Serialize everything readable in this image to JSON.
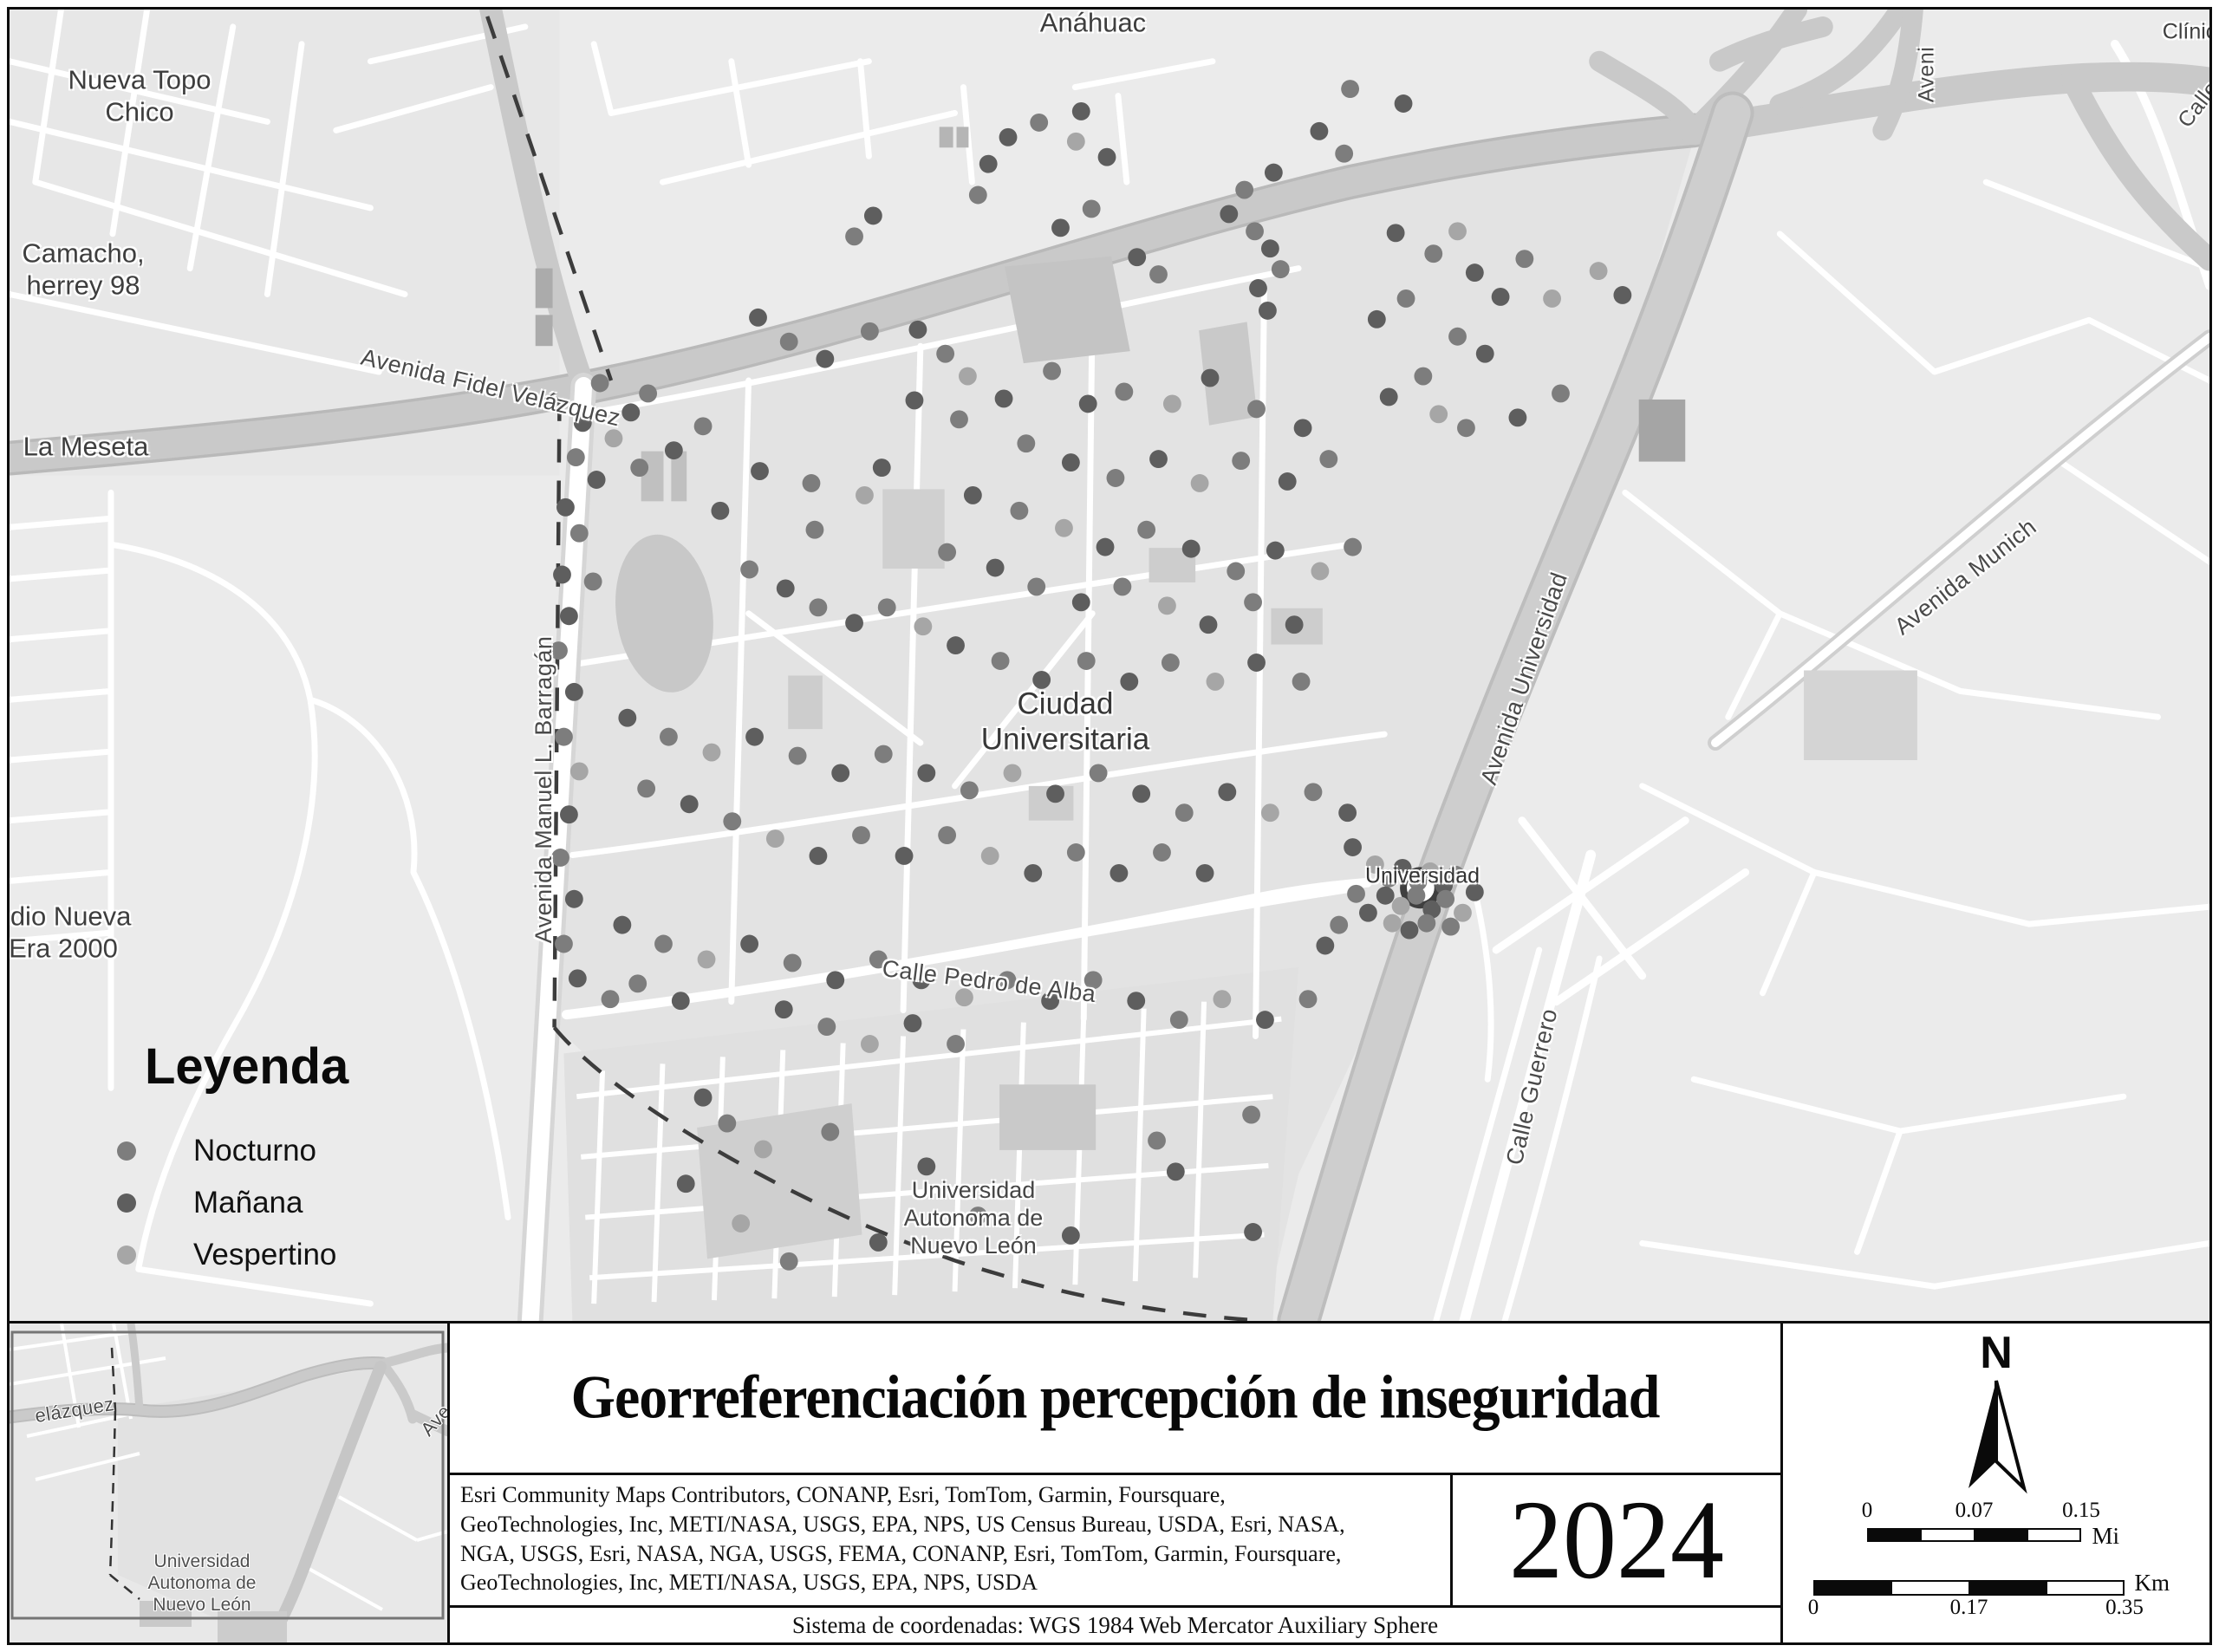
{
  "map": {
    "labels": {
      "anahuac": "Anáhuac",
      "nueva_topo_chico": "Nueva Topo\nChico",
      "camacho": "Camacho,\nherrey 98",
      "la_meseta": "La Meseta",
      "nueva_era": "edio Nueva\nEra 2000",
      "fidel_velazquez": "Avenida Fidel Velázquez",
      "barragan": "Avenida Manuel L. Barragán",
      "ciudad_universitaria": "Ciudad\nUniversitaria",
      "avenida_universidad": "Avenida Universidad",
      "avenida_munich": "Avenida Munich",
      "calle_guerrero": "Calle Guerrero",
      "universidad_station": "Universidad",
      "pedro_de_alba": "Calle Pedro de Alba",
      "uanl": "Universidad\nAutonoma de\nNuevo León",
      "clinica": "Clínica",
      "aveni": "Aveni",
      "calle": "Calle"
    },
    "legend": {
      "title": "Leyenda",
      "items": [
        {
          "key": "n",
          "label": "Nocturno",
          "color": "#7d7d7d"
        },
        {
          "key": "m",
          "label": "Mañana",
          "color": "#5e5e5e"
        },
        {
          "key": "v",
          "label": "Vespertino",
          "color": "#a6a6a6"
        }
      ]
    },
    "dot_colors": {
      "n": "#7d7d7d",
      "m": "#5e5e5e",
      "v": "#a6a6a6"
    },
    "dots": [
      [
        1162,
        148,
        "m"
      ],
      [
        1198,
        131,
        "n"
      ],
      [
        1139,
        179,
        "m"
      ],
      [
        1241,
        153,
        "v"
      ],
      [
        1277,
        171,
        "m"
      ],
      [
        1524,
        141,
        "m"
      ],
      [
        1553,
        167,
        "n"
      ],
      [
        1471,
        189,
        "m"
      ],
      [
        1437,
        209,
        "n"
      ],
      [
        1419,
        237,
        "m"
      ],
      [
        1449,
        257,
        "n"
      ],
      [
        1467,
        277,
        "m"
      ],
      [
        1127,
        215,
        "n"
      ],
      [
        1005,
        239,
        "m"
      ],
      [
        983,
        263,
        "n"
      ],
      [
        1223,
        253,
        "m"
      ],
      [
        1259,
        231,
        "n"
      ],
      [
        1312,
        287,
        "m"
      ],
      [
        1337,
        307,
        "n"
      ],
      [
        1453,
        323,
        "m"
      ],
      [
        1479,
        301,
        "n"
      ],
      [
        1464,
        349,
        "m"
      ],
      [
        1560,
        92,
        "n"
      ],
      [
        1622,
        109,
        "m"
      ],
      [
        1247,
        118,
        "m"
      ],
      [
        1613,
        259,
        "m"
      ],
      [
        1657,
        283,
        "n"
      ],
      [
        1685,
        257,
        "v"
      ],
      [
        1705,
        305,
        "m"
      ],
      [
        1763,
        289,
        "n"
      ],
      [
        1735,
        333,
        "m"
      ],
      [
        1795,
        335,
        "v"
      ],
      [
        1625,
        335,
        "n"
      ],
      [
        1591,
        359,
        "m"
      ],
      [
        1685,
        379,
        "n"
      ],
      [
        1717,
        399,
        "m"
      ],
      [
        1645,
        425,
        "n"
      ],
      [
        1605,
        449,
        "m"
      ],
      [
        1663,
        469,
        "v"
      ],
      [
        1695,
        485,
        "n"
      ],
      [
        1755,
        473,
        "m"
      ],
      [
        1805,
        445,
        "n"
      ],
      [
        1849,
        303,
        "v"
      ],
      [
        1877,
        331,
        "m"
      ],
      [
        871,
        357,
        "m"
      ],
      [
        907,
        385,
        "n"
      ],
      [
        949,
        405,
        "m"
      ],
      [
        1001,
        373,
        "n"
      ],
      [
        1057,
        371,
        "m"
      ],
      [
        1089,
        399,
        "n"
      ],
      [
        1115,
        425,
        "v"
      ],
      [
        1053,
        453,
        "m"
      ],
      [
        1105,
        475,
        "n"
      ],
      [
        1157,
        451,
        "m"
      ],
      [
        1213,
        419,
        "n"
      ],
      [
        1255,
        457,
        "m"
      ],
      [
        1297,
        443,
        "n"
      ],
      [
        1353,
        457,
        "v"
      ],
      [
        1397,
        427,
        "m"
      ],
      [
        1451,
        463,
        "n"
      ],
      [
        1505,
        485,
        "m"
      ],
      [
        1183,
        503,
        "n"
      ],
      [
        1235,
        525,
        "m"
      ],
      [
        1287,
        543,
        "n"
      ],
      [
        1337,
        521,
        "m"
      ],
      [
        1385,
        549,
        "v"
      ],
      [
        1433,
        523,
        "n"
      ],
      [
        1487,
        547,
        "m"
      ],
      [
        1535,
        521,
        "n"
      ],
      [
        687,
        433,
        "n"
      ],
      [
        667,
        479,
        "m"
      ],
      [
        703,
        497,
        "v"
      ],
      [
        723,
        467,
        "m"
      ],
      [
        743,
        445,
        "n"
      ],
      [
        659,
        519,
        "n"
      ],
      [
        683,
        545,
        "m"
      ],
      [
        733,
        531,
        "n"
      ],
      [
        773,
        511,
        "m"
      ],
      [
        807,
        483,
        "n"
      ],
      [
        647,
        577,
        "m"
      ],
      [
        663,
        607,
        "n"
      ],
      [
        643,
        655,
        "m"
      ],
      [
        679,
        663,
        "n"
      ],
      [
        651,
        703,
        "m"
      ],
      [
        639,
        743,
        "n"
      ],
      [
        657,
        791,
        "m"
      ],
      [
        645,
        843,
        "n"
      ],
      [
        663,
        883,
        "v"
      ],
      [
        651,
        933,
        "m"
      ],
      [
        641,
        983,
        "n"
      ],
      [
        657,
        1031,
        "m"
      ],
      [
        645,
        1083,
        "n"
      ],
      [
        661,
        1123,
        "m"
      ],
      [
        699,
        1147,
        "n"
      ],
      [
        827,
        581,
        "m"
      ],
      [
        937,
        603,
        "n"
      ],
      [
        995,
        563,
        "v"
      ],
      [
        1015,
        531,
        "m"
      ],
      [
        933,
        549,
        "n"
      ],
      [
        873,
        535,
        "m"
      ],
      [
        1121,
        563,
        "m"
      ],
      [
        1175,
        581,
        "n"
      ],
      [
        1227,
        601,
        "v"
      ],
      [
        1275,
        623,
        "m"
      ],
      [
        1323,
        603,
        "n"
      ],
      [
        1375,
        625,
        "m"
      ],
      [
        1427,
        651,
        "n"
      ],
      [
        1473,
        627,
        "m"
      ],
      [
        1525,
        651,
        "v"
      ],
      [
        1563,
        623,
        "n"
      ],
      [
        1091,
        629,
        "n"
      ],
      [
        1147,
        647,
        "m"
      ],
      [
        1195,
        669,
        "n"
      ],
      [
        1247,
        687,
        "m"
      ],
      [
        1295,
        669,
        "n"
      ],
      [
        1347,
        691,
        "v"
      ],
      [
        1395,
        713,
        "m"
      ],
      [
        1447,
        687,
        "n"
      ],
      [
        1495,
        713,
        "m"
      ],
      [
        861,
        649,
        "n"
      ],
      [
        903,
        671,
        "m"
      ],
      [
        941,
        693,
        "n"
      ],
      [
        983,
        711,
        "m"
      ],
      [
        1021,
        693,
        "n"
      ],
      [
        1063,
        715,
        "v"
      ],
      [
        1101,
        737,
        "m"
      ],
      [
        1153,
        755,
        "n"
      ],
      [
        1201,
        777,
        "m"
      ],
      [
        1253,
        755,
        "n"
      ],
      [
        1303,
        779,
        "m"
      ],
      [
        1351,
        757,
        "n"
      ],
      [
        1403,
        779,
        "v"
      ],
      [
        1451,
        757,
        "m"
      ],
      [
        1503,
        779,
        "n"
      ],
      [
        719,
        821,
        "m"
      ],
      [
        767,
        843,
        "n"
      ],
      [
        817,
        861,
        "v"
      ],
      [
        867,
        843,
        "m"
      ],
      [
        917,
        865,
        "n"
      ],
      [
        967,
        885,
        "m"
      ],
      [
        1017,
        863,
        "n"
      ],
      [
        1067,
        885,
        "m"
      ],
      [
        1117,
        905,
        "n"
      ],
      [
        1167,
        885,
        "v"
      ],
      [
        1217,
        909,
        "m"
      ],
      [
        1267,
        885,
        "n"
      ],
      [
        1317,
        909,
        "m"
      ],
      [
        1367,
        931,
        "n"
      ],
      [
        1417,
        907,
        "m"
      ],
      [
        1467,
        931,
        "v"
      ],
      [
        1517,
        907,
        "n"
      ],
      [
        1557,
        931,
        "m"
      ],
      [
        741,
        903,
        "n"
      ],
      [
        791,
        921,
        "m"
      ],
      [
        841,
        941,
        "n"
      ],
      [
        891,
        961,
        "v"
      ],
      [
        941,
        981,
        "m"
      ],
      [
        991,
        957,
        "n"
      ],
      [
        1041,
        981,
        "m"
      ],
      [
        1091,
        957,
        "n"
      ],
      [
        1141,
        981,
        "v"
      ],
      [
        1191,
        1001,
        "m"
      ],
      [
        1241,
        977,
        "n"
      ],
      [
        1291,
        1001,
        "m"
      ],
      [
        1341,
        977,
        "n"
      ],
      [
        1391,
        1001,
        "m"
      ],
      [
        1589,
        991,
        "v"
      ],
      [
        1605,
        1007,
        "n"
      ],
      [
        1621,
        995,
        "m"
      ],
      [
        1639,
        1011,
        "n"
      ],
      [
        1653,
        999,
        "v"
      ],
      [
        1669,
        1015,
        "m"
      ],
      [
        1683,
        1003,
        "n"
      ],
      [
        1601,
        1027,
        "m"
      ],
      [
        1619,
        1039,
        "v"
      ],
      [
        1637,
        1027,
        "n"
      ],
      [
        1655,
        1043,
        "m"
      ],
      [
        1671,
        1031,
        "n"
      ],
      [
        1609,
        1059,
        "v"
      ],
      [
        1629,
        1067,
        "m"
      ],
      [
        1649,
        1059,
        "n"
      ],
      [
        1581,
        1047,
        "m"
      ],
      [
        1567,
        1025,
        "n"
      ],
      [
        1691,
        1047,
        "v"
      ],
      [
        1705,
        1023,
        "m"
      ],
      [
        1677,
        1063,
        "n"
      ],
      [
        1563,
        971,
        "m"
      ],
      [
        1547,
        1061,
        "n"
      ],
      [
        1531,
        1085,
        "m"
      ],
      [
        713,
        1061,
        "m"
      ],
      [
        761,
        1083,
        "n"
      ],
      [
        811,
        1101,
        "v"
      ],
      [
        861,
        1083,
        "m"
      ],
      [
        911,
        1105,
        "n"
      ],
      [
        961,
        1125,
        "m"
      ],
      [
        1011,
        1101,
        "n"
      ],
      [
        1061,
        1125,
        "m"
      ],
      [
        1111,
        1145,
        "v"
      ],
      [
        1161,
        1125,
        "n"
      ],
      [
        1211,
        1149,
        "m"
      ],
      [
        1261,
        1125,
        "n"
      ],
      [
        1311,
        1149,
        "m"
      ],
      [
        1361,
        1171,
        "n"
      ],
      [
        1411,
        1147,
        "v"
      ],
      [
        1461,
        1171,
        "m"
      ],
      [
        1511,
        1147,
        "n"
      ],
      [
        901,
        1159,
        "m"
      ],
      [
        951,
        1179,
        "n"
      ],
      [
        1001,
        1199,
        "v"
      ],
      [
        1051,
        1175,
        "m"
      ],
      [
        1101,
        1199,
        "n"
      ],
      [
        731,
        1129,
        "n"
      ],
      [
        781,
        1149,
        "m"
      ],
      [
        807,
        1261,
        "m"
      ],
      [
        835,
        1291,
        "n"
      ],
      [
        877,
        1321,
        "v"
      ],
      [
        787,
        1361,
        "m"
      ],
      [
        955,
        1301,
        "n"
      ],
      [
        1067,
        1341,
        "m"
      ],
      [
        1335,
        1311,
        "n"
      ],
      [
        1357,
        1347,
        "m"
      ],
      [
        1445,
        1281,
        "n"
      ],
      [
        1235,
        1421,
        "m"
      ],
      [
        907,
        1451,
        "n"
      ],
      [
        1447,
        1417,
        "m"
      ],
      [
        1127,
        1398,
        "n"
      ],
      [
        851,
        1407,
        "v"
      ],
      [
        1011,
        1429,
        "m"
      ]
    ]
  },
  "inset": {
    "labels": {
      "velazquez": "elázquez",
      "ave": "Ave",
      "uanl": "Universidad\nAutonoma de\nNuevo León"
    }
  },
  "title_block": {
    "title": "Georreferenciación percepción de inseguridad",
    "attribution": "Esri Community Maps Contributors, CONANP, Esri, TomTom, Garmin, Foursquare,\nGeoTechnologies, Inc, METI/NASA, USGS, EPA, NPS, US Census Bureau, USDA, Esri, NASA,\nNGA, USGS, Esri, NASA, NGA, USGS, FEMA, CONANP, Esri, TomTom, Garmin, Foursquare,\nGeoTechnologies, Inc, METI/NASA, USGS, EPA, NPS, USDA",
    "year": "2024",
    "coordinate_system": "Sistema de coordenadas: WGS 1984 Web Mercator Auxiliary Sphere"
  },
  "north_scale": {
    "north_label": "N",
    "miles": {
      "ticks": [
        "0",
        "0.07",
        "0.15"
      ],
      "unit": "Mi"
    },
    "km": {
      "ticks": [
        "0",
        "0.17",
        "0.35"
      ],
      "unit": "Km"
    }
  }
}
